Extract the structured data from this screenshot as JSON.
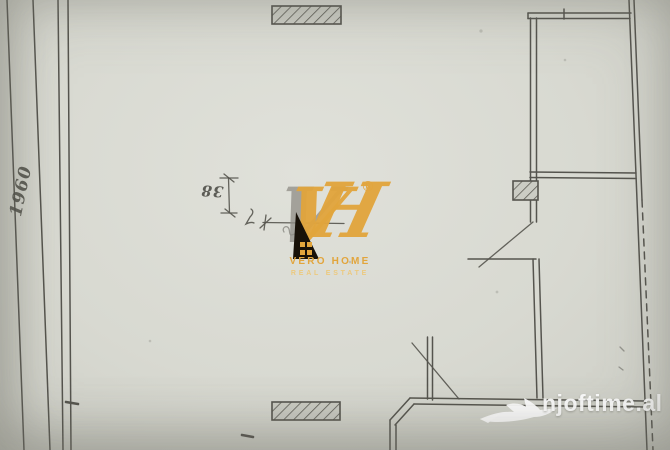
{
  "palette": {
    "paper": "#d8d9d1",
    "line": "#55544e",
    "logo_gold": "#e2a53c",
    "logo_gold_light": "#ecc97f",
    "logo_black": "#181108",
    "monogram_gray": "#908d86",
    "watermark_white": "#ffffff"
  },
  "plan": {
    "dim_value": "38",
    "side_note": "1960"
  },
  "logo": {
    "monogram_v": "V",
    "monogram_h": "H",
    "registered": "®",
    "name": "VERO HOME",
    "tagline": "REAL ESTATE"
  },
  "watermark": {
    "text": "njoftime.al"
  }
}
